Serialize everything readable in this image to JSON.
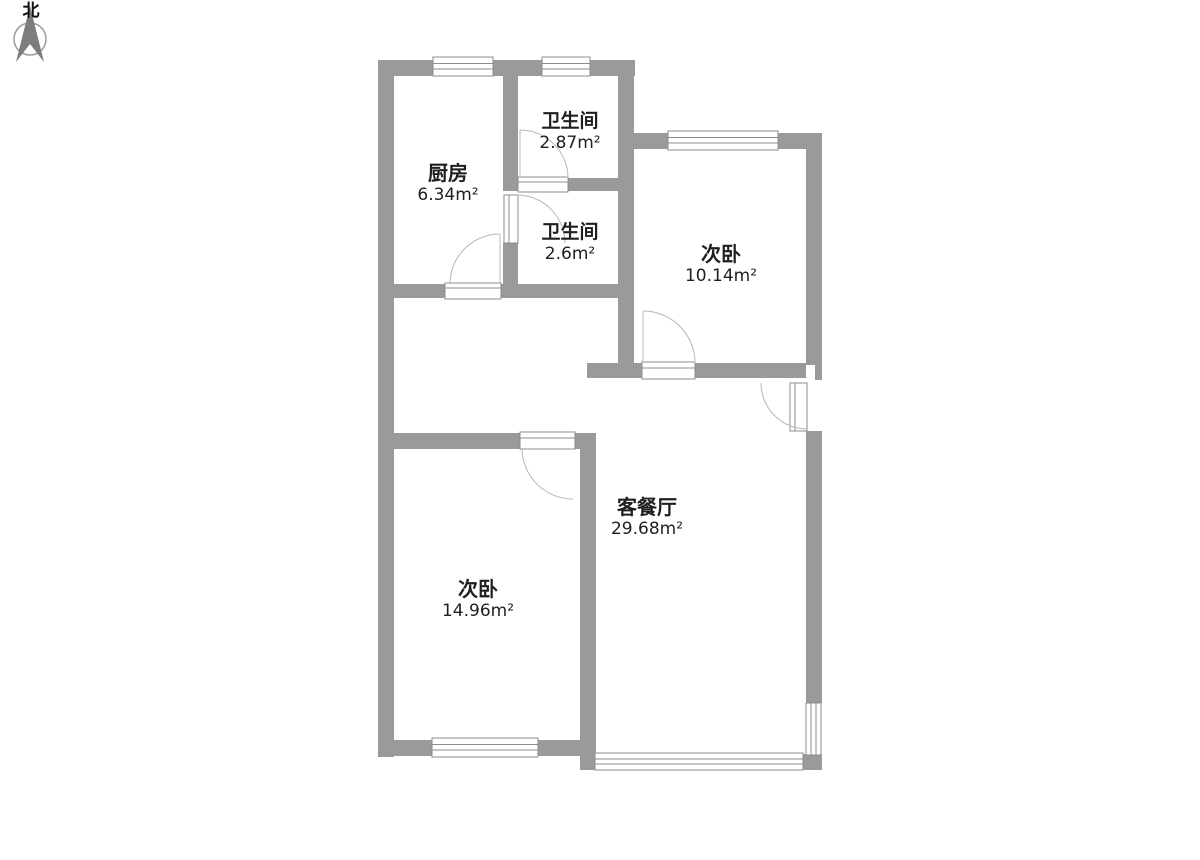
{
  "compass": {
    "label": "北"
  },
  "rooms": {
    "kitchen": {
      "name": "厨房",
      "area": "6.34m²"
    },
    "bath_top": {
      "name": "卫生间",
      "area": "2.87m²"
    },
    "bath_mid": {
      "name": "卫生间",
      "area": "2.6m²"
    },
    "bedroom_tr": {
      "name": "次卧",
      "area": "10.14m²"
    },
    "living": {
      "name": "客餐厅",
      "area": "29.68m²"
    },
    "bedroom_bl": {
      "name": "次卧",
      "area": "14.96m²"
    }
  },
  "colors": {
    "wall": "#9a9a9a",
    "frame_outline": "#8c8c8c",
    "door_arc": "#b8b8b8",
    "text": "#1f1f1f"
  }
}
